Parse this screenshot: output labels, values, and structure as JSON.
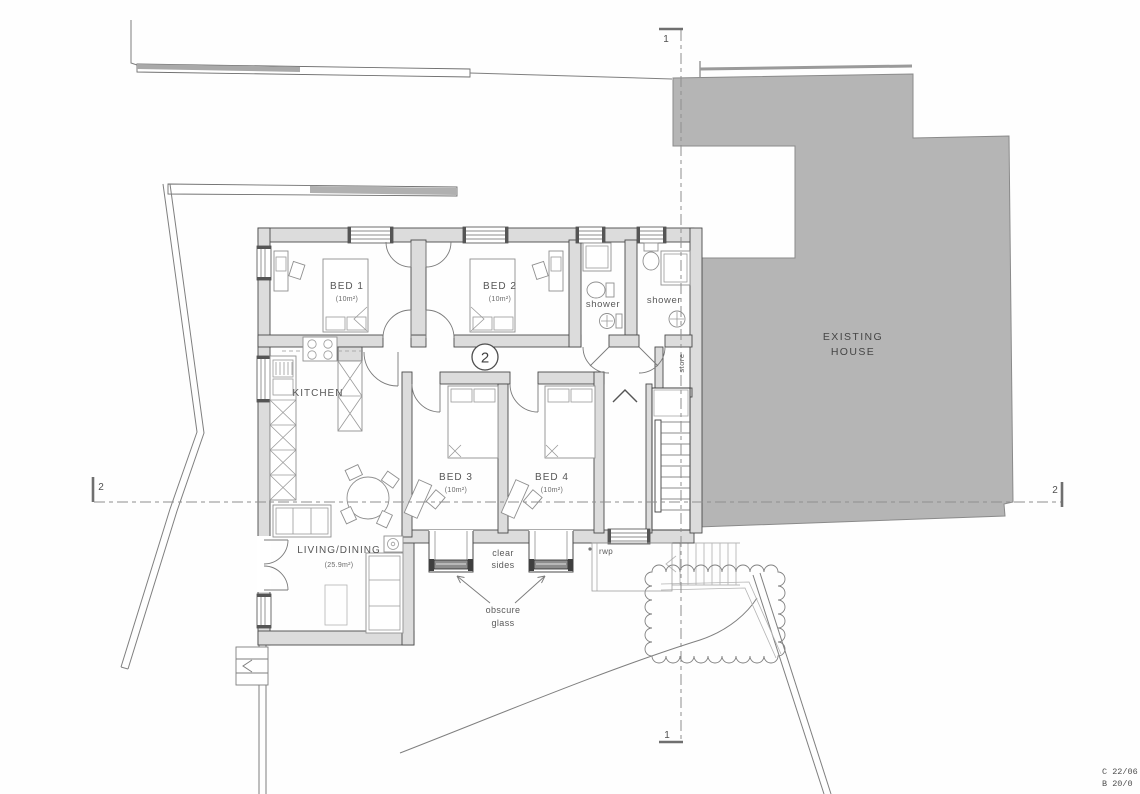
{
  "plan": {
    "unit_number": "2",
    "rooms": {
      "bed1": {
        "name": "BED 1",
        "area": "(10m²)"
      },
      "bed2": {
        "name": "BED 2",
        "area": "(10m²)"
      },
      "bed3": {
        "name": "BED 3",
        "area": "(10m²)"
      },
      "bed4": {
        "name": "BED 4",
        "area": "(10m²)"
      },
      "kitchen": {
        "name": "KITCHEN"
      },
      "living_dining": {
        "name": "LIVING/DINING",
        "area": "(25.9m²)"
      },
      "shower_left": {
        "name": "shower"
      },
      "shower_right": {
        "name": "shower"
      },
      "store": {
        "name": "store"
      }
    },
    "existing_house": {
      "label_line1": "EXISTING",
      "label_line2": "HOUSE"
    },
    "annotations": {
      "clear_sides": {
        "line1": "clear",
        "line2": "sides"
      },
      "obscure_glass": {
        "line1": "obscure",
        "line2": "glass"
      },
      "rwp": "rwp"
    },
    "sections": {
      "one": "1",
      "two": "2"
    },
    "revisions": {
      "row1": "C 22/06",
      "row2": "B 20/0"
    },
    "colors": {
      "existing_house_fill": "#b5b5b5",
      "wall_fill": "#dcdcdc"
    }
  }
}
